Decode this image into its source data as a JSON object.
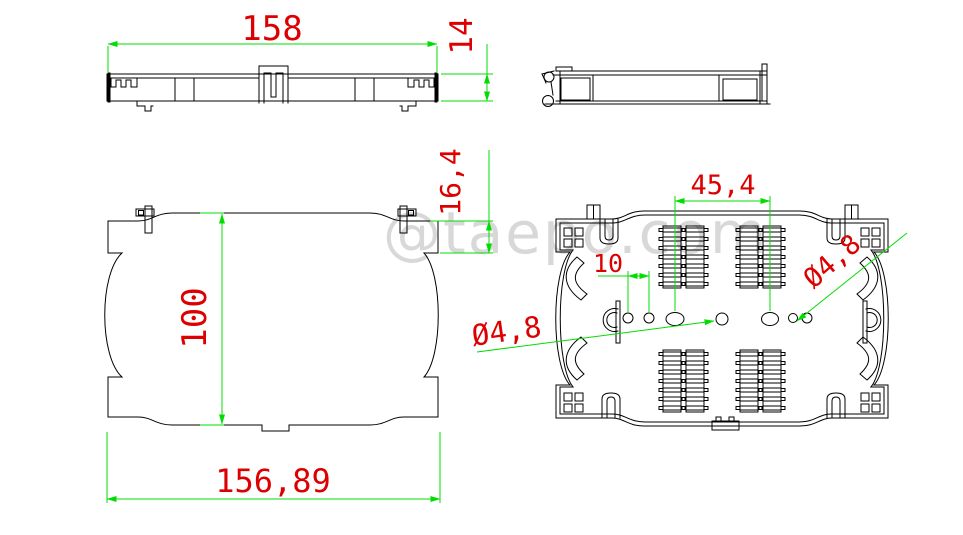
{
  "watermark": "@taepo.com",
  "colors": {
    "drawing": "#000000",
    "dim-line": "#00dd00",
    "dim-text": "#dd0000",
    "watermark": "#d8d8d8"
  },
  "dimensions": {
    "front_width": "158",
    "front_height": "14",
    "cover_height": "100",
    "cover_width": "156,89",
    "edge_offset": "16,4",
    "hole_span": "45,4",
    "hole_pitch": "10",
    "hole_dia_left": "Ø4,8",
    "hole_dia_right": "Ø4,8"
  }
}
